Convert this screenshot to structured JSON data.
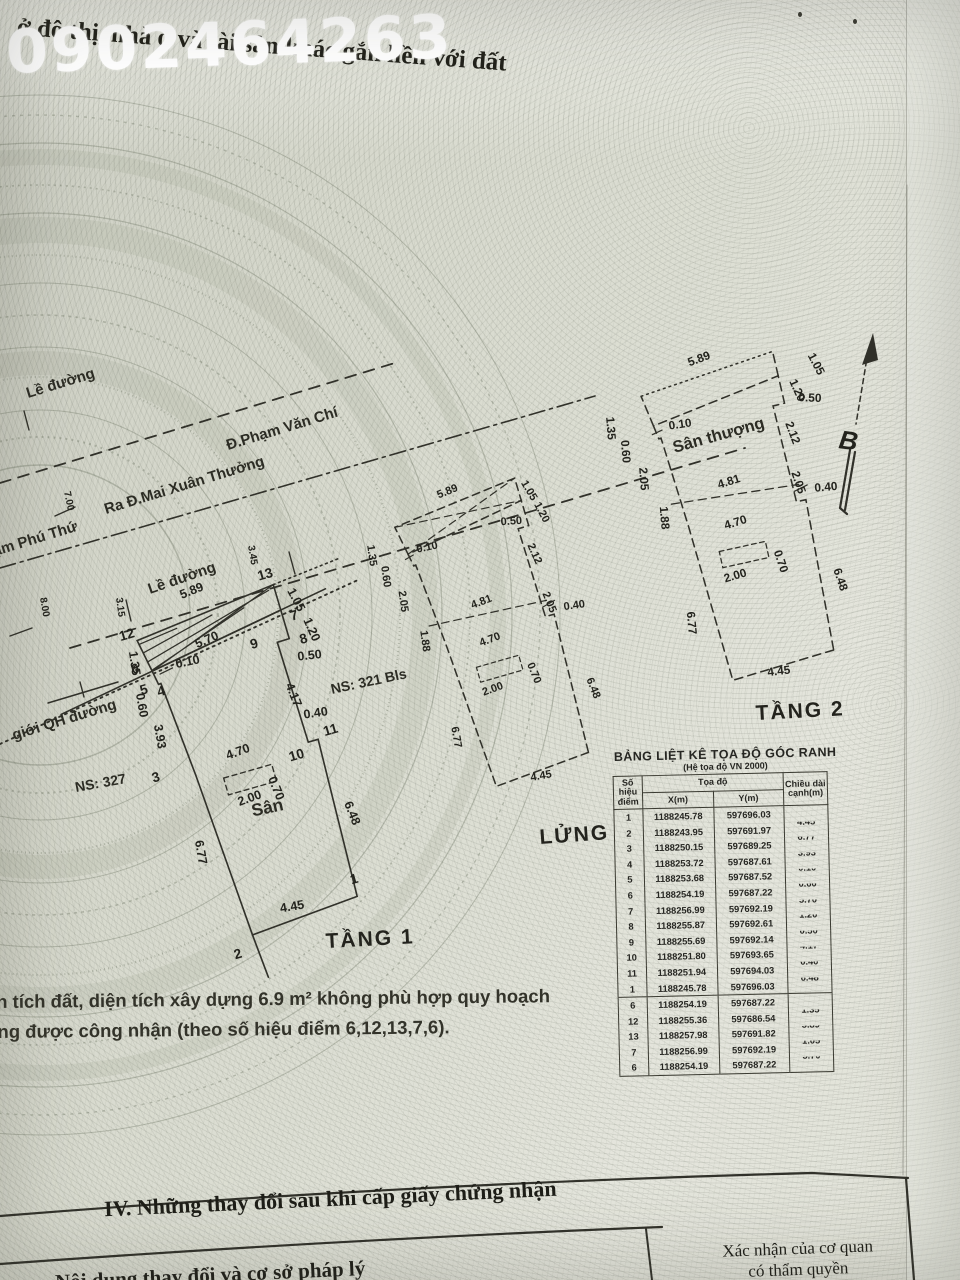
{
  "watermark": "0902464263",
  "header": {
    "title_fragment": "ở đô thị, nhà ở và tài sản khác gắn liền với đất"
  },
  "streets": {
    "le_duong_1": "Lề đường",
    "pham_phu_thu": "Đ.Phạm Phú Thứ",
    "pham_van_chi": "Đ.Phạm Văn Chí",
    "mai_xuan_thuong": "Ra Đ.Mai Xuân Thưởng",
    "le_duong_2": "Lề đường",
    "qh_boundary": "giới QH đường"
  },
  "dims": {
    "d010": "0.10",
    "d040": "0.40",
    "d050": "0.50",
    "d060": "0.60",
    "d070": "0.70",
    "d105": "1.05",
    "d120": "1.20",
    "d135": "1.35",
    "d188": "1.88",
    "d200": "2.00",
    "d205": "2.05",
    "d212": "2.12",
    "d315": "3.15",
    "d345": "3.45",
    "d393": "3.93",
    "d417": "4.17",
    "d445": "4.45",
    "d470": "4.70",
    "d481": "4.81",
    "d570": "5.70",
    "d589": "5.89",
    "d648": "6.48",
    "d677": "6.77",
    "d700": "7.00",
    "d800": "8.00"
  },
  "points": [
    "1",
    "2",
    "3",
    "4",
    "5",
    "6",
    "7",
    "8",
    "9",
    "10",
    "11",
    "12",
    "13"
  ],
  "plans": {
    "tang1": {
      "title": "TẦNG 1",
      "ns_327": "NS: 327",
      "ns_321": "NS: 321 Bls",
      "san": "Sân"
    },
    "lung": {
      "title": "LỬNG"
    },
    "tang2": {
      "title": "TẦNG 2",
      "san_thuong": "Sân thượng",
      "north_letter": "B"
    }
  },
  "note": {
    "line1": "ện tích đất, diện tích xây dựng 6.9 m² không phù hợp quy hoạch",
    "line2": "ông được công nhận (theo số hiệu điểm 6,12,13,7,6)."
  },
  "table": {
    "title": "BẢNG LIỆT KÊ TỌA ĐỘ GÓC RANH",
    "subtitle": "(Hệ tọa độ VN 2000)",
    "col_point": "Số hiệu điểm",
    "col_coord": "Tọa độ",
    "col_x": "X(m)",
    "col_y": "Y(m)",
    "col_len": "Chiều dài cạnh(m)",
    "rows": [
      {
        "p": "1",
        "x": "1188245.78",
        "y": "597696.03",
        "l": ""
      },
      {
        "p": "2",
        "x": "1188243.95",
        "y": "597691.97",
        "l": "4.45"
      },
      {
        "p": "3",
        "x": "1188250.15",
        "y": "597689.25",
        "l": "6.77"
      },
      {
        "p": "4",
        "x": "1188253.72",
        "y": "597687.61",
        "l": "3.93"
      },
      {
        "p": "5",
        "x": "1188253.68",
        "y": "597687.52",
        "l": "0.10"
      },
      {
        "p": "6",
        "x": "1188254.19",
        "y": "597687.22",
        "l": "0.60"
      },
      {
        "p": "7",
        "x": "1188256.99",
        "y": "597692.19",
        "l": "5.70"
      },
      {
        "p": "8",
        "x": "1188255.87",
        "y": "597692.61",
        "l": "1.20"
      },
      {
        "p": "9",
        "x": "1188255.69",
        "y": "597692.14",
        "l": "0.50"
      },
      {
        "p": "10",
        "x": "1188251.80",
        "y": "597693.65",
        "l": "4.17"
      },
      {
        "p": "11",
        "x": "1188251.94",
        "y": "597694.03",
        "l": "0.40"
      },
      {
        "p": "1",
        "x": "1188245.78",
        "y": "597696.03",
        "l": "6.48"
      },
      {
        "p": "6",
        "x": "1188254.19",
        "y": "597687.22",
        "l": ""
      },
      {
        "p": "12",
        "x": "1188255.36",
        "y": "597686.54",
        "l": "1.35"
      },
      {
        "p": "13",
        "x": "1188257.98",
        "y": "597691.82",
        "l": "5.89"
      },
      {
        "p": "7",
        "x": "1188256.99",
        "y": "597692.19",
        "l": "1.05"
      },
      {
        "p": "6",
        "x": "1188254.19",
        "y": "597687.22",
        "l": "5.70"
      }
    ]
  },
  "section4": {
    "heading": "IV. Những thay đổi sau khi cấp giấy chứng nhận",
    "left_label": "Nội dung thay đổi và cơ sở pháp lý",
    "right_line1": "Xác nhận của cơ quan",
    "right_line2": "có thẩm quyền"
  }
}
